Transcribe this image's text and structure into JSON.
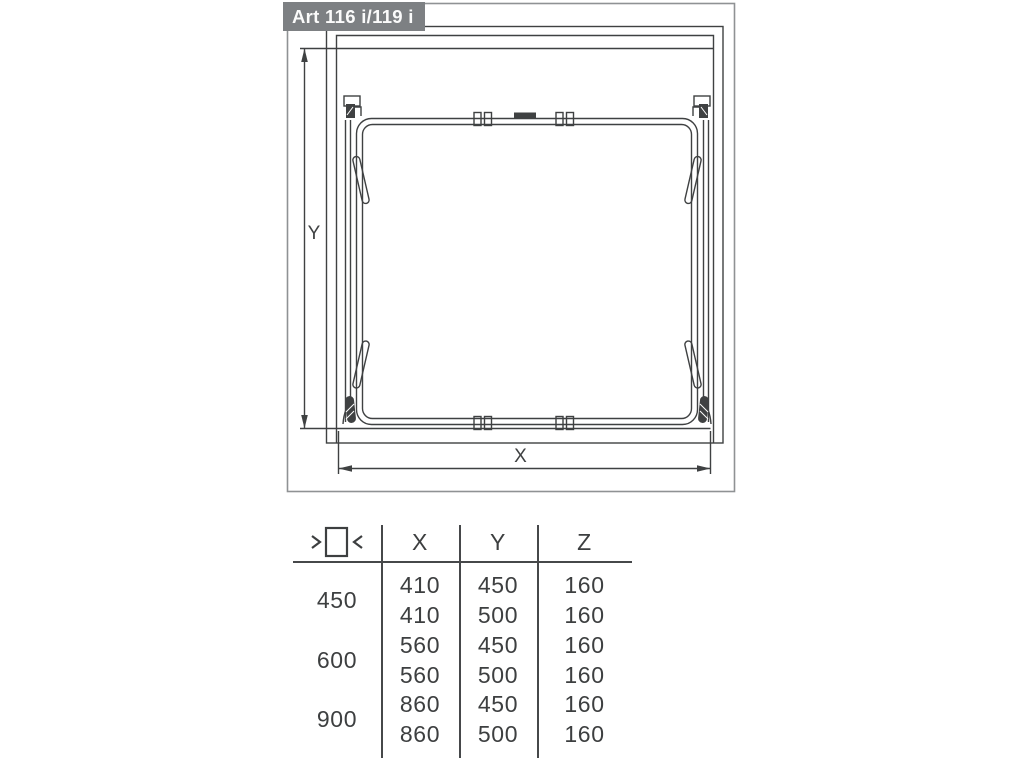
{
  "title": "Art 116 i/119 i",
  "diagram": {
    "dim_vertical_label": "Y",
    "dim_horizontal_label": "X",
    "icons": [
      "y-dimension-arrow",
      "x-dimension-arrow",
      "cabinet-outline",
      "pullout-frame"
    ]
  },
  "table": {
    "header": {
      "icon": "cabinet-width-icon",
      "col_x": "X",
      "col_y": "Y",
      "col_z": "Z"
    },
    "groups": [
      {
        "label": "450",
        "rows": [
          {
            "x": "410",
            "y": "450",
            "z": "160"
          },
          {
            "x": "410",
            "y": "500",
            "z": "160"
          }
        ]
      },
      {
        "label": "600",
        "rows": [
          {
            "x": "560",
            "y": "450",
            "z": "160"
          },
          {
            "x": "560",
            "y": "500",
            "z": "160"
          }
        ]
      },
      {
        "label": "900",
        "rows": [
          {
            "x": "860",
            "y": "450",
            "z": "160"
          },
          {
            "x": "860",
            "y": "500",
            "z": "160"
          }
        ]
      }
    ]
  },
  "colors": {
    "title_bg": "#7d8083",
    "title_text": "#fbfbfb",
    "line": "#3f4142",
    "outer_border": "#8f9294",
    "table_text": "#3d3f40"
  }
}
